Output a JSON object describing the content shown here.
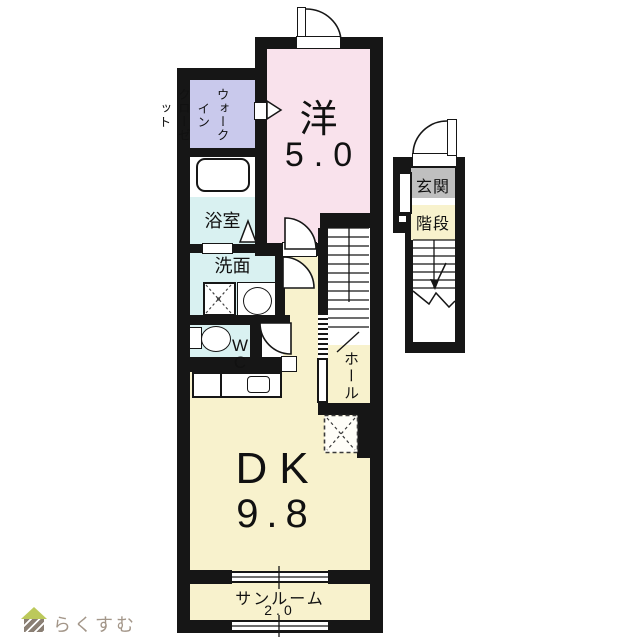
{
  "floorplan": {
    "unit_main": {
      "bedroom": {
        "name_label": "洋",
        "area_label": "5.0"
      },
      "closet": {
        "label": "ウォークイン\nクローゼット"
      },
      "bathroom": {
        "label": "浴室"
      },
      "washroom": {
        "label": "洗面"
      },
      "toilet": {
        "label": "W\nC"
      },
      "dining_kitchen": {
        "name_label": "DK",
        "area_label": "9.8"
      },
      "sunroom": {
        "name_label": "サンルーム",
        "area_label": "2.0"
      },
      "hall": {
        "label": "ホール"
      }
    },
    "unit_stair": {
      "entrance": {
        "label": "玄関"
      },
      "staircase": {
        "label": "階段"
      }
    },
    "colors": {
      "bedroom": "#f9e2ec",
      "closet": "#c9c9ec",
      "wet_rooms": "#d9f1f1",
      "living": "#f8f2cd",
      "entrance_gray": "#bfbfbf",
      "wall": "#161616"
    }
  },
  "footer": {
    "logo_text": "らくすむ"
  }
}
